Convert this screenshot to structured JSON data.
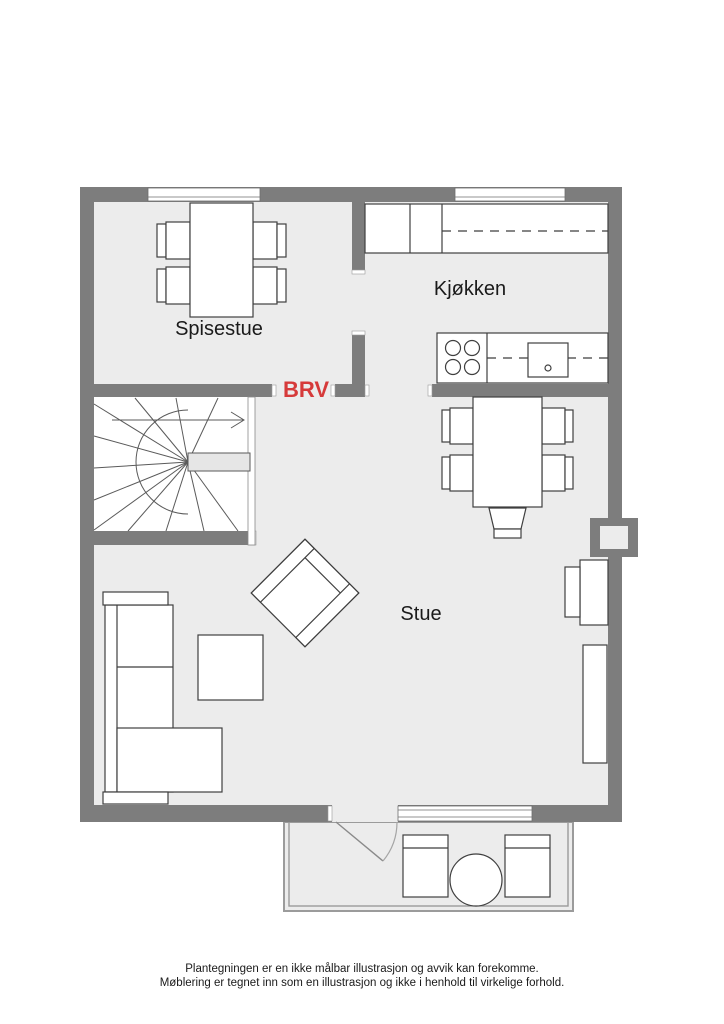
{
  "floorplan": {
    "type": "floor-plan",
    "rooms": [
      {
        "name": "Spisestue"
      },
      {
        "name": "Kjøkken"
      },
      {
        "name": "Stue"
      }
    ],
    "labels": {
      "brv": "BRV"
    },
    "colors": {
      "wall": "#7d7d7d",
      "floor": "#ececec",
      "furniture_fill": "#ffffff",
      "furniture_outline": "#3f3f3f",
      "brv_red": "#d63a3a"
    },
    "features": [
      "winder-staircase",
      "balcony",
      "kitchen-counters",
      "stove",
      "sink",
      "dining-table-4-chairs",
      "dining-table-5-chairs",
      "corner-sofa",
      "coffee-table",
      "armchair",
      "tv-bench",
      "sideboard",
      "chimney",
      "balcony-chairs",
      "round-table",
      "door-swing",
      "windows"
    ]
  },
  "footer": {
    "line1": "Plantegningen er en ikke målbar illustrasjon og avvik kan forekomme.",
    "line2": "Møblering er tegnet inn som en illustrasjon og ikke i henhold til virkelige forhold."
  }
}
